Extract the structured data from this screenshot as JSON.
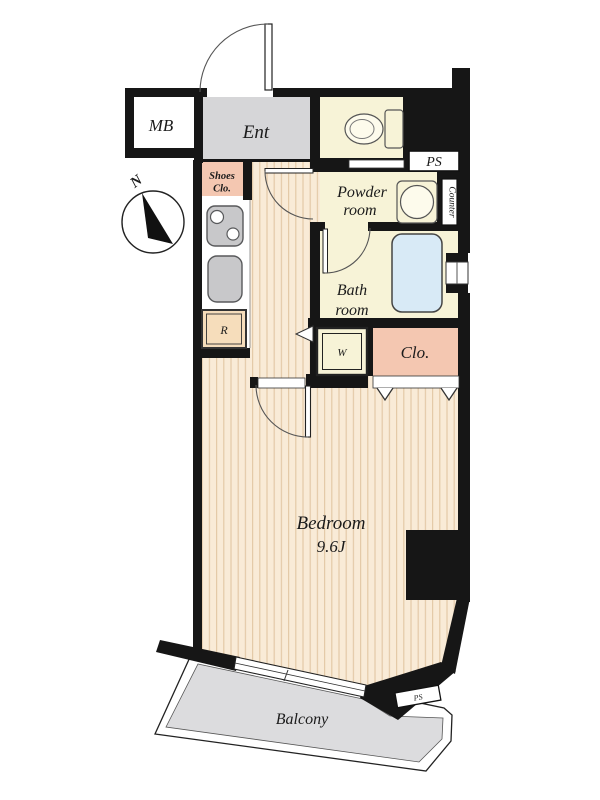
{
  "plan": {
    "type": "apartment-floor-plan",
    "bedroom_size": "9.6J"
  },
  "labels": {
    "mb": "MB",
    "ent": "Ent",
    "shoes_line1": "Shoes",
    "shoes_line2": "Clo.",
    "compass_north": "N",
    "ps_upper": "PS",
    "powder_line1": "Powder",
    "powder_line2": "room",
    "counter": "Counter",
    "bath_line1": "Bath",
    "bath_line2": "room",
    "fridge": "R",
    "washer": "W",
    "closet": "Clo.",
    "bedroom_line1": "Bedroom",
    "bedroom_line2": "9.6J",
    "balcony": "Balcony",
    "ps_lower": "PS"
  },
  "colors": {
    "wall": "#161616",
    "cream": "#f7f3d7",
    "salmon": "#f4c7b1",
    "floor_base": "#f9ebd7",
    "floor_stripe": "#e3c9a7",
    "ent_gray": "#d6d6d8",
    "balcony_gray": "#dcdcde",
    "tub_blue": "#d8eaf6",
    "fixture_gray": "#c8c8ca",
    "fridge_fill": "#f6ddbb",
    "shoes_text": "#b5382a",
    "white": "#ffffff"
  }
}
